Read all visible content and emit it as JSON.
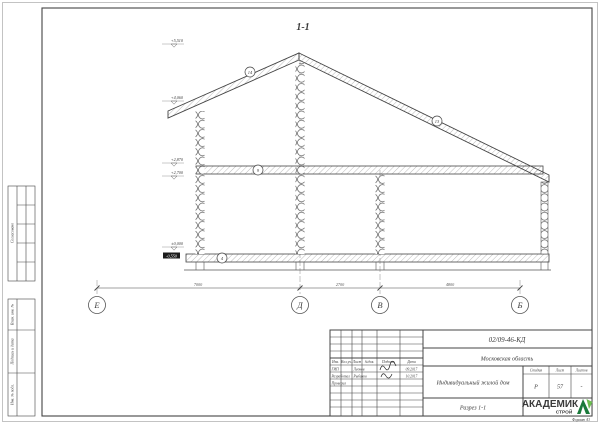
{
  "sheet": {
    "section_title": "1-1",
    "format_note": "Формат А3"
  },
  "colors": {
    "line": "#444444",
    "accent_green": "#27963c",
    "accent_green_dark": "#1b7a3b"
  },
  "side_column": {
    "approved_label": "Согласовано",
    "cells": [
      "Взам. инв. №",
      "Подпись и дата",
      "Инв. № подл."
    ]
  },
  "elevations": [
    "+5,510",
    "+4,060",
    "+2,870",
    "+2,700",
    "±0,000",
    "-0,550"
  ],
  "axes": [
    "Е",
    "Д",
    "В",
    "Б"
  ],
  "dimensions": [
    "7000",
    "2700",
    "4800"
  ],
  "detail_markers": [
    "14",
    "13",
    "9",
    "4"
  ],
  "title_block": {
    "doc_number": "02/09-46-КД",
    "region": "Московская область",
    "project_name": "Индивидуальный жилой дом",
    "drawing_name": "Разрез 1-1",
    "columns": {
      "stage_label": "Стадия",
      "sheet_label": "Лист",
      "sheets_label": "Листов",
      "stage": "Р",
      "sheet": "57",
      "sheets": "-"
    },
    "header": [
      "Изм.",
      "Кол.уч.",
      "Лист",
      "№док.",
      "Подпись",
      "Дата"
    ],
    "rows": [
      {
        "role": "ГИП",
        "name": "Леонов",
        "date": "09.2017"
      },
      {
        "role": "Разработал",
        "name": "Рыбаков",
        "date": "10.2017"
      },
      {
        "role": "Проверил",
        "name": "",
        "date": ""
      }
    ],
    "logo": {
      "line1": "АКАДЕМИК",
      "line2": "СТРОЙ",
      "icon": "house-leaf-icon"
    }
  }
}
